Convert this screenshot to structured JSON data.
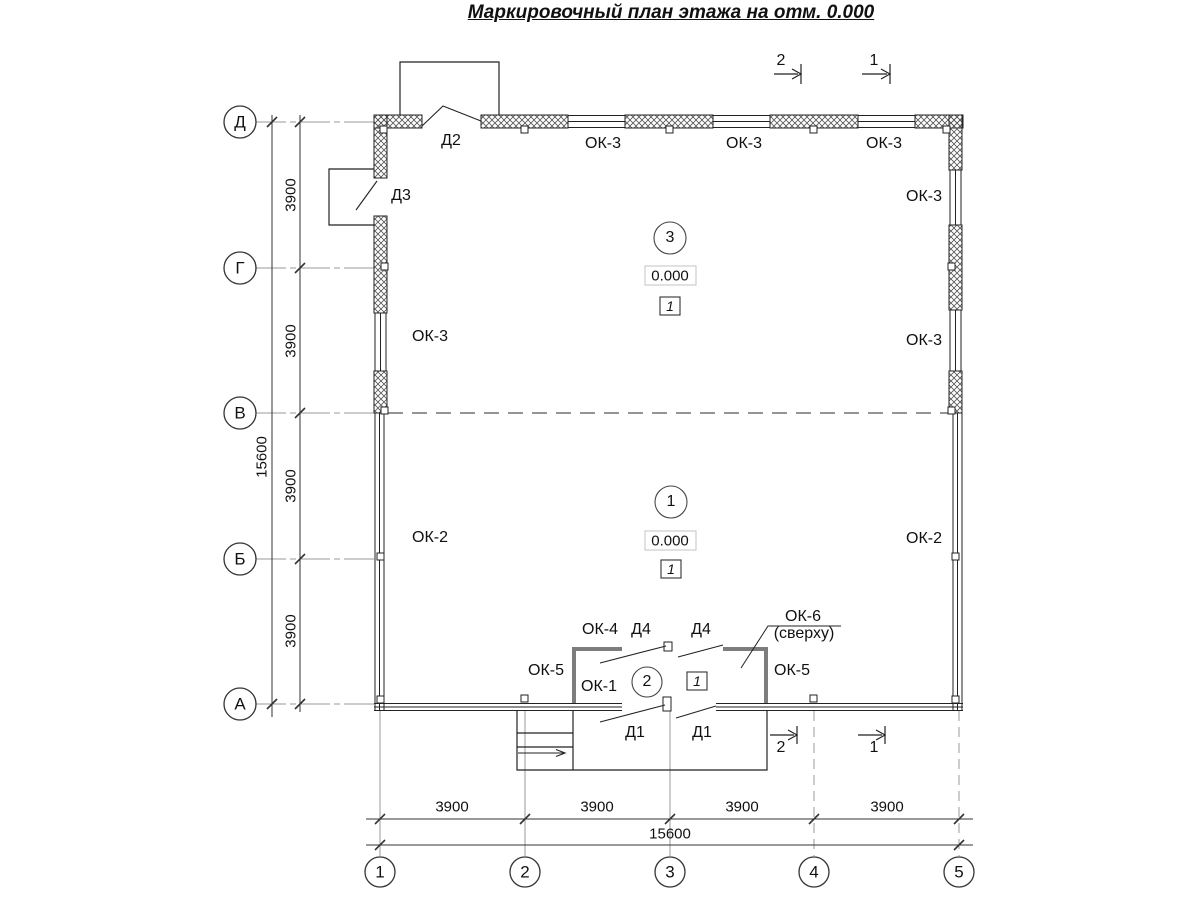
{
  "title": "Маркировочный план этажа на отм. 0.000",
  "accent_colors": {
    "line": "#222222",
    "aux_line": "#888888",
    "tambour_wall": "#7d7d7d",
    "hatch": "#555555"
  },
  "annotations": [
    {
      "name": "axis-row-label-d",
      "text": "Д",
      "x": 240,
      "y": 122,
      "fs": 17
    },
    {
      "name": "axis-row-label-g",
      "text": "Г",
      "x": 240,
      "y": 268,
      "fs": 17
    },
    {
      "name": "axis-row-label-v",
      "text": "В",
      "x": 240,
      "y": 413,
      "fs": 17
    },
    {
      "name": "axis-row-label-b",
      "text": "Б",
      "x": 240,
      "y": 559,
      "fs": 17
    },
    {
      "name": "axis-row-label-a",
      "text": "А",
      "x": 240,
      "y": 704,
      "fs": 17
    },
    {
      "name": "axis-col-label-1",
      "text": "1",
      "x": 380,
      "y": 872,
      "fs": 17
    },
    {
      "name": "axis-col-label-2",
      "text": "2",
      "x": 525,
      "y": 872,
      "fs": 17
    },
    {
      "name": "axis-col-label-3",
      "text": "3",
      "x": 670,
      "y": 872,
      "fs": 17
    },
    {
      "name": "axis-col-label-4",
      "text": "4",
      "x": 814,
      "y": 872,
      "fs": 17
    },
    {
      "name": "axis-col-label-5",
      "text": "5",
      "x": 959,
      "y": 872,
      "fs": 17
    },
    {
      "name": "dim-left-3900-1",
      "text": "3900",
      "x": 291,
      "y": 195,
      "fs": 15,
      "rot": true
    },
    {
      "name": "dim-left-3900-2",
      "text": "3900",
      "x": 291,
      "y": 341,
      "fs": 15,
      "rot": true
    },
    {
      "name": "dim-left-3900-3",
      "text": "3900",
      "x": 291,
      "y": 486,
      "fs": 15,
      "rot": true
    },
    {
      "name": "dim-left-3900-4",
      "text": "3900",
      "x": 291,
      "y": 631,
      "fs": 15,
      "rot": true
    },
    {
      "name": "dim-left-total-15600",
      "text": "15600",
      "x": 262,
      "y": 457,
      "fs": 15,
      "rot": true
    },
    {
      "name": "dim-bottom-3900-1",
      "text": "3900",
      "x": 452,
      "y": 807,
      "fs": 15
    },
    {
      "name": "dim-bottom-3900-2",
      "text": "3900",
      "x": 597,
      "y": 807,
      "fs": 15
    },
    {
      "name": "dim-bottom-3900-3",
      "text": "3900",
      "x": 742,
      "y": 807,
      "fs": 15
    },
    {
      "name": "dim-bottom-3900-4",
      "text": "3900",
      "x": 887,
      "y": 807,
      "fs": 15
    },
    {
      "name": "dim-bottom-total-15600",
      "text": "15600",
      "x": 670,
      "y": 834,
      "fs": 15
    },
    {
      "name": "label-door-d2",
      "text": "Д2",
      "x": 451,
      "y": 141
    },
    {
      "name": "label-door-d3",
      "text": "Д3",
      "x": 401,
      "y": 196
    },
    {
      "name": "label-window-ok3-top-1",
      "text": "ОК-3",
      "x": 603,
      "y": 144
    },
    {
      "name": "label-window-ok3-top-2",
      "text": "ОК-3",
      "x": 744,
      "y": 144
    },
    {
      "name": "label-window-ok3-top-3",
      "text": "ОК-3",
      "x": 884,
      "y": 144
    },
    {
      "name": "label-window-ok3-right-upper",
      "text": "ОК-3",
      "x": 924,
      "y": 197
    },
    {
      "name": "label-window-ok3-left",
      "text": "ОК-3",
      "x": 430,
      "y": 337
    },
    {
      "name": "label-window-ok3-right-lower",
      "text": "ОК-3",
      "x": 924,
      "y": 341
    },
    {
      "name": "label-window-ok2-left",
      "text": "ОК-2",
      "x": 430,
      "y": 538
    },
    {
      "name": "label-window-ok2-right",
      "text": "ОК-2",
      "x": 924,
      "y": 539
    },
    {
      "name": "label-window-ok4",
      "text": "ОК-4",
      "x": 600,
      "y": 630
    },
    {
      "name": "label-door-d4-left",
      "text": "Д4",
      "x": 641,
      "y": 630
    },
    {
      "name": "label-door-d4-right",
      "text": "Д4",
      "x": 701,
      "y": 630
    },
    {
      "name": "label-window-ok6",
      "text": "ОК-6",
      "x": 803,
      "y": 617
    },
    {
      "name": "label-window-ok6-note",
      "text": "(сверху)",
      "x": 804,
      "y": 634
    },
    {
      "name": "label-window-ok5-left",
      "text": "ОК-5",
      "x": 546,
      "y": 671
    },
    {
      "name": "label-window-ok5-right",
      "text": "ОК-5",
      "x": 792,
      "y": 671
    },
    {
      "name": "label-window-ok1",
      "text": "ОК-1",
      "x": 599,
      "y": 687
    },
    {
      "name": "label-door-d1-left",
      "text": "Д1",
      "x": 635,
      "y": 733
    },
    {
      "name": "label-door-d1-right",
      "text": "Д1",
      "x": 702,
      "y": 733
    },
    {
      "name": "section-mark-2-top",
      "text": "2",
      "x": 781,
      "y": 61
    },
    {
      "name": "section-mark-1-top",
      "text": "1",
      "x": 874,
      "y": 61
    },
    {
      "name": "section-mark-2-bottom",
      "text": "2",
      "x": 781,
      "y": 748
    },
    {
      "name": "section-mark-1-bottom",
      "text": "1",
      "x": 874,
      "y": 748
    },
    {
      "name": "room-3-number",
      "text": "3",
      "x": 670,
      "y": 238
    },
    {
      "name": "room-3-elevation",
      "text": "0.000",
      "x": 670,
      "y": 276,
      "fs": 15
    },
    {
      "name": "room-3-floor-type",
      "text": "1",
      "x": 670,
      "y": 306,
      "fs": 14,
      "it": true
    },
    {
      "name": "room-1-number",
      "text": "1",
      "x": 671,
      "y": 502
    },
    {
      "name": "room-1-elevation",
      "text": "0.000",
      "x": 670,
      "y": 541,
      "fs": 15
    },
    {
      "name": "room-1-floor-type",
      "text": "1",
      "x": 671,
      "y": 569,
      "fs": 14,
      "it": true
    },
    {
      "name": "room-2-number",
      "text": "2",
      "x": 647,
      "y": 682
    },
    {
      "name": "room-2-floor-type",
      "text": "1",
      "x": 697,
      "y": 681,
      "fs": 14,
      "it": true
    }
  ]
}
